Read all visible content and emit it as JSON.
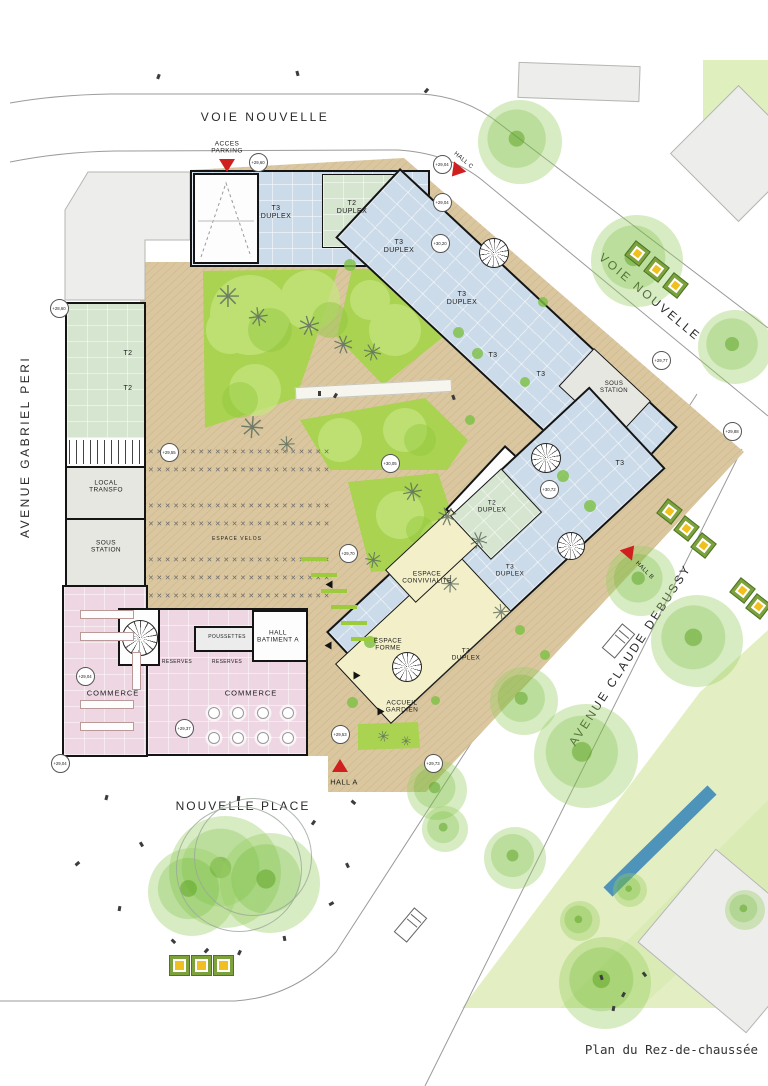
{
  "title_block": {
    "caption": "Plan du Rez-de-chaussée"
  },
  "streets": {
    "voie_nouvelle_top": "VOIE NOUVELLE",
    "voie_nouvelle_right": "VOIE NOUVELLE",
    "avenue_gabriel_peri": "AVENUE GABRIEL PERI",
    "avenue_claude_debussy": "AVENUE CLAUDE DEBUSSY",
    "nouvelle_place": "NOUVELLE PLACE"
  },
  "colors": {
    "wall": "#141414",
    "unit_blue": "#ccdbe9",
    "unit_green": "#d6e5cf",
    "commerce_pink": "#eed6e3",
    "common_yellow": "#f2efc9",
    "utility_grey": "#e7e7e2",
    "deck_tan": "#dac79f",
    "lawn_green": "#a9d351",
    "entrance_red": "#cf1f1f",
    "water_blue": "#4e93b9",
    "park_green": "#e3efc3",
    "planter_yellow": "#f0c020"
  },
  "plan_labels": [
    {
      "x": 276,
      "y": 213,
      "t": "T3\nDUPLEX",
      "s": 7
    },
    {
      "x": 352,
      "y": 208,
      "t": "T2\nDUPLEX",
      "s": 7
    },
    {
      "x": 399,
      "y": 247,
      "t": "T3\nDUPLEX",
      "s": 7
    },
    {
      "x": 462,
      "y": 299,
      "t": "T3\nDUPLEX",
      "s": 7
    },
    {
      "x": 128,
      "y": 354,
      "t": "T2",
      "s": 7
    },
    {
      "x": 128,
      "y": 389,
      "t": "T2",
      "s": 7
    },
    {
      "x": 106,
      "y": 487,
      "t": "LOCAL\nTRANSFO",
      "s": 6.5
    },
    {
      "x": 106,
      "y": 547,
      "t": "SOUS\nSTATION",
      "s": 6.5
    },
    {
      "x": 237,
      "y": 540,
      "t": "ESPACE VELOS",
      "s": 5,
      "sp": 1
    },
    {
      "x": 493,
      "y": 356,
      "t": "T3",
      "s": 7
    },
    {
      "x": 541,
      "y": 375,
      "t": "T3",
      "s": 7
    },
    {
      "x": 614,
      "y": 388,
      "t": "SOUS\nSTATION",
      "s": 6
    },
    {
      "x": 620,
      "y": 464,
      "t": "T3",
      "s": 7
    },
    {
      "x": 492,
      "y": 507,
      "t": "T2\nDUPLEX",
      "s": 6.5
    },
    {
      "x": 510,
      "y": 571,
      "t": "T3\nDUPLEX",
      "s": 6.5
    },
    {
      "x": 427,
      "y": 578,
      "t": "ESPACE\nCONVIVIALITE",
      "s": 6.5
    },
    {
      "x": 388,
      "y": 645,
      "t": "ESPACE\nFORME",
      "s": 6.5
    },
    {
      "x": 466,
      "y": 655,
      "t": "T3\nDUPLEX",
      "s": 6.5
    },
    {
      "x": 402,
      "y": 707,
      "t": "ACCUEIL\nGARDIEN",
      "s": 6.5
    },
    {
      "x": 113,
      "y": 694,
      "t": "COMMERCE",
      "s": 7.5,
      "sp": 1
    },
    {
      "x": 251,
      "y": 694,
      "t": "COMMERCE",
      "s": 7.5,
      "sp": 1
    },
    {
      "x": 177,
      "y": 663,
      "t": "RESERVES",
      "s": 5
    },
    {
      "x": 227,
      "y": 663,
      "t": "RESERVES",
      "s": 5
    },
    {
      "x": 227,
      "y": 638,
      "t": "POUSSETTES",
      "s": 5
    },
    {
      "x": 278,
      "y": 637,
      "t": "HALL\nBATIMENT A",
      "s": 6.5
    },
    {
      "x": 344,
      "y": 783,
      "t": "HALL A",
      "s": 7.5
    },
    {
      "x": 463,
      "y": 161,
      "t": "HALL C",
      "s": 6,
      "r": 40
    },
    {
      "x": 644,
      "y": 571,
      "t": "HALL B",
      "s": 6,
      "r": 45
    },
    {
      "x": 227,
      "y": 148,
      "t": "ACCES\nPARKING",
      "s": 6.5
    }
  ],
  "elevations": [
    {
      "x": 257,
      "y": 161,
      "v": "+29,60"
    },
    {
      "x": 441,
      "y": 163,
      "v": "+29,04"
    },
    {
      "x": 441,
      "y": 201,
      "v": "+29,04"
    },
    {
      "x": 439,
      "y": 242,
      "v": "+30,20"
    },
    {
      "x": 58,
      "y": 307,
      "v": "+28,60"
    },
    {
      "x": 168,
      "y": 451,
      "v": "+29,55"
    },
    {
      "x": 389,
      "y": 462,
      "v": "+30,05"
    },
    {
      "x": 347,
      "y": 552,
      "v": "+29,70"
    },
    {
      "x": 548,
      "y": 488,
      "v": "+30,72"
    },
    {
      "x": 660,
      "y": 359,
      "v": "+29,77"
    },
    {
      "x": 731,
      "y": 430,
      "v": "+29,88"
    },
    {
      "x": 84,
      "y": 675,
      "v": "+29,04"
    },
    {
      "x": 183,
      "y": 727,
      "v": "+29,37"
    },
    {
      "x": 59,
      "y": 762,
      "v": "+29,04"
    },
    {
      "x": 339,
      "y": 733,
      "v": "+29,53"
    },
    {
      "x": 432,
      "y": 762,
      "v": "+29,73"
    }
  ],
  "entrance_markers": [
    {
      "x": 227,
      "y": 166,
      "r": 0,
      "name": "acces-parking"
    },
    {
      "x": 456,
      "y": 172,
      "r": 40,
      "name": "hall-c"
    },
    {
      "x": 630,
      "y": 551,
      "r": 220,
      "name": "hall-b"
    },
    {
      "x": 340,
      "y": 766,
      "r": 180,
      "name": "hall-a"
    }
  ],
  "planters": [
    {
      "x": 636,
      "y": 252,
      "r": 38,
      "s": 17
    },
    {
      "x": 655,
      "y": 268,
      "r": 38,
      "s": 17
    },
    {
      "x": 674,
      "y": 284,
      "r": 38,
      "s": 17
    },
    {
      "x": 668,
      "y": 510,
      "r": 38,
      "s": 17
    },
    {
      "x": 685,
      "y": 527,
      "r": 38,
      "s": 17
    },
    {
      "x": 702,
      "y": 544,
      "r": 38,
      "s": 17
    },
    {
      "x": 741,
      "y": 589,
      "r": 38,
      "s": 17
    },
    {
      "x": 757,
      "y": 605,
      "r": 38,
      "s": 17
    },
    {
      "x": 178,
      "y": 964,
      "r": 0,
      "s": 19
    },
    {
      "x": 200,
      "y": 964,
      "r": 0,
      "s": 19
    },
    {
      "x": 222,
      "y": 964,
      "r": 0,
      "s": 19
    }
  ],
  "trees": [
    {
      "x": 520,
      "y": 142,
      "d": 84
    },
    {
      "x": 637,
      "y": 261,
      "d": 92
    },
    {
      "x": 735,
      "y": 347,
      "d": 74
    },
    {
      "x": 641,
      "y": 581,
      "d": 70
    },
    {
      "x": 697,
      "y": 641,
      "d": 92
    },
    {
      "x": 586,
      "y": 756,
      "d": 104
    },
    {
      "x": 524,
      "y": 701,
      "d": 68
    },
    {
      "x": 437,
      "y": 790,
      "d": 60
    },
    {
      "x": 515,
      "y": 858,
      "d": 62
    },
    {
      "x": 580,
      "y": 921,
      "d": 40
    },
    {
      "x": 605,
      "y": 983,
      "d": 92
    },
    {
      "x": 630,
      "y": 890,
      "d": 34
    },
    {
      "x": 445,
      "y": 829,
      "d": 46
    },
    {
      "x": 225,
      "y": 872,
      "d": 112
    },
    {
      "x": 270,
      "y": 883,
      "d": 100
    },
    {
      "x": 192,
      "y": 892,
      "d": 88
    },
    {
      "x": 745,
      "y": 910,
      "d": 40
    }
  ],
  "tree_rings": [
    {
      "x": 252,
      "y": 856,
      "d": 116
    },
    {
      "x": 238,
      "y": 868,
      "d": 124
    }
  ],
  "shrubs": [
    {
      "x": 350,
      "y": 265,
      "d": 12
    },
    {
      "x": 458,
      "y": 332,
      "d": 11
    },
    {
      "x": 477,
      "y": 353,
      "d": 11
    },
    {
      "x": 543,
      "y": 302,
      "d": 10
    },
    {
      "x": 563,
      "y": 476,
      "d": 12
    },
    {
      "x": 590,
      "y": 506,
      "d": 12
    },
    {
      "x": 370,
      "y": 642,
      "d": 12
    },
    {
      "x": 352,
      "y": 702,
      "d": 11
    },
    {
      "x": 470,
      "y": 420,
      "d": 10
    },
    {
      "x": 520,
      "y": 630,
      "d": 10
    },
    {
      "x": 545,
      "y": 655,
      "d": 10
    },
    {
      "x": 525,
      "y": 382,
      "d": 10
    },
    {
      "x": 435,
      "y": 700,
      "d": 9
    }
  ],
  "sketch_trees": [
    {
      "x": 228,
      "y": 298,
      "s": 30
    },
    {
      "x": 258,
      "y": 317,
      "s": 26
    },
    {
      "x": 308,
      "y": 326,
      "s": 28
    },
    {
      "x": 343,
      "y": 345,
      "s": 26
    },
    {
      "x": 371,
      "y": 353,
      "s": 24
    },
    {
      "x": 252,
      "y": 429,
      "s": 30
    },
    {
      "x": 286,
      "y": 445,
      "s": 22
    },
    {
      "x": 412,
      "y": 492,
      "s": 26
    },
    {
      "x": 447,
      "y": 517,
      "s": 26
    },
    {
      "x": 477,
      "y": 541,
      "s": 24
    },
    {
      "x": 373,
      "y": 561,
      "s": 22
    },
    {
      "x": 449,
      "y": 585,
      "s": 24
    },
    {
      "x": 500,
      "y": 612,
      "s": 22
    },
    {
      "x": 383,
      "y": 737,
      "s": 15
    },
    {
      "x": 406,
      "y": 741,
      "s": 13
    }
  ],
  "people": [
    {
      "x": 157,
      "y": 74,
      "r": 20
    },
    {
      "x": 296,
      "y": 71,
      "r": -15
    },
    {
      "x": 425,
      "y": 88,
      "r": 40
    },
    {
      "x": 318,
      "y": 391,
      "r": 0
    },
    {
      "x": 334,
      "y": 393,
      "r": 30
    },
    {
      "x": 452,
      "y": 395,
      "r": -20
    },
    {
      "x": 105,
      "y": 795,
      "r": 15
    },
    {
      "x": 140,
      "y": 842,
      "r": -30
    },
    {
      "x": 76,
      "y": 861,
      "r": 50
    },
    {
      "x": 118,
      "y": 906,
      "r": 10
    },
    {
      "x": 172,
      "y": 939,
      "r": -45
    },
    {
      "x": 238,
      "y": 950,
      "r": 25
    },
    {
      "x": 283,
      "y": 936,
      "r": -10
    },
    {
      "x": 330,
      "y": 901,
      "r": 60
    },
    {
      "x": 346,
      "y": 863,
      "r": -25
    },
    {
      "x": 312,
      "y": 820,
      "r": 35
    },
    {
      "x": 352,
      "y": 800,
      "r": -50
    },
    {
      "x": 237,
      "y": 796,
      "r": 5
    },
    {
      "x": 205,
      "y": 948,
      "r": 42
    },
    {
      "x": 600,
      "y": 975,
      "r": -18
    },
    {
      "x": 622,
      "y": 992,
      "r": 28
    },
    {
      "x": 643,
      "y": 972,
      "r": -38
    },
    {
      "x": 612,
      "y": 1006,
      "r": 12
    }
  ]
}
